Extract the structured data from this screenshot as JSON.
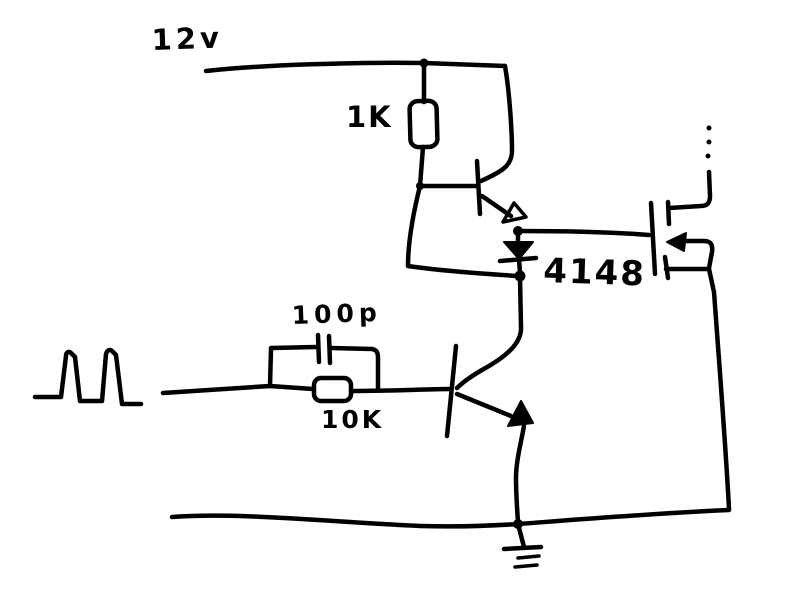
{
  "colors": {
    "ink": "#000000",
    "background": "#ffffff"
  },
  "labels": {
    "supply_rail": "12v",
    "r1": "1K",
    "c1": "100p",
    "r2": "10K",
    "d1": "4148"
  }
}
